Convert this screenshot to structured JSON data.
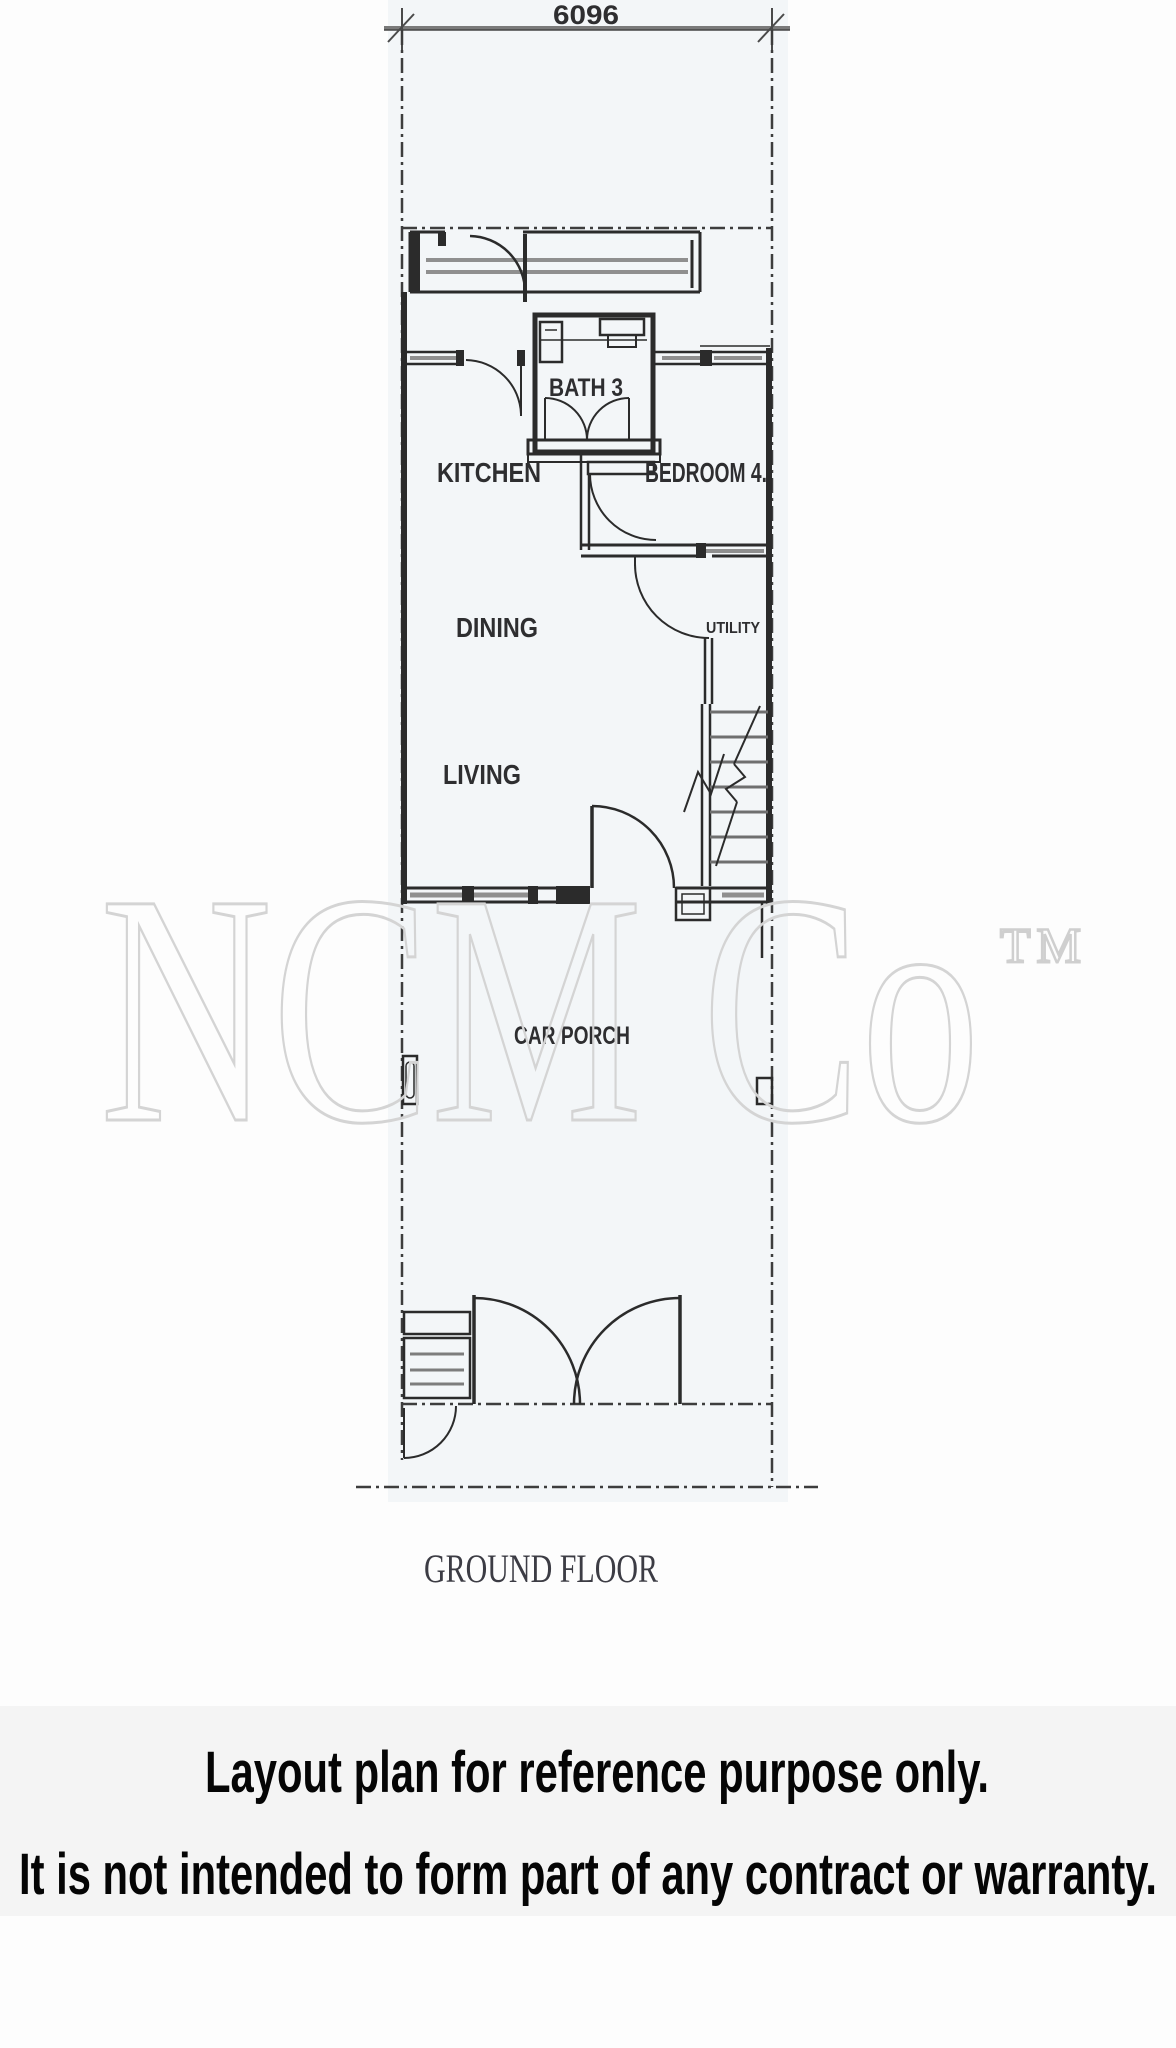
{
  "colors": {
    "paper": "#fdfdfd",
    "sheet_tint": "#f3f6f8",
    "ink": "#2b2b2b",
    "thin_line": "#4a4a4a",
    "window_gray": "#8f8f8f",
    "watermark_gray": "#d4d4d4",
    "title_gray": "#3c3c44",
    "disclaimer_band": "#f4f4f4"
  },
  "plan": {
    "dimension_label": "6096",
    "labels": {
      "bath": "BATH 3",
      "kitchen": "KITCHEN",
      "bedroom": "BEDROOM 4.",
      "dining": "DINING",
      "utility": "UTILITY",
      "living": "LIVING",
      "car_porch": "CAR PORCH"
    },
    "floor_title": "GROUND FLOOR"
  },
  "watermark": {
    "text": "NCM Co",
    "trademark": "TM"
  },
  "disclaimer": {
    "line1": "Layout plan for reference purpose only.",
    "line2": "It is not intended to form part of any contract or warranty."
  }
}
